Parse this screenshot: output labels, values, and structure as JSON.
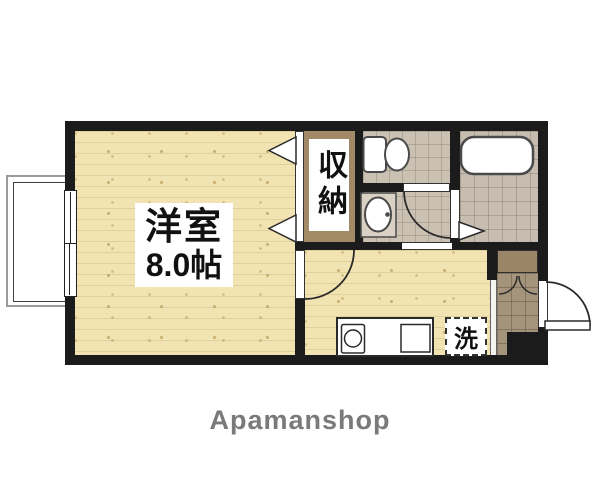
{
  "brand": {
    "name": "Apamanshop"
  },
  "rooms": {
    "main": {
      "name": "洋室",
      "size": "8.0帖"
    },
    "closet": {
      "name": "収納"
    },
    "washer_pan": {
      "mark": "洗"
    }
  },
  "fixtures": [
    "toilet",
    "washbasin",
    "bathtub",
    "kitchen-sink",
    "stove",
    "washing-machine-pan",
    "sliding-window",
    "balcony",
    "entry-door",
    "folding-door",
    "swing-door",
    "shoe-cabinet"
  ],
  "colors": {
    "wall": "#1b1b1b",
    "wood_floor": "#f2e4b2",
    "sanitary_floor": "#cbc1b2",
    "bath_floor": "#c6bcaf",
    "closet_floor": "#a28a66",
    "genkan_tile": "#a4947c",
    "shoe_cabinet": "#9a8567",
    "brand_text": "#7a7a7a"
  }
}
